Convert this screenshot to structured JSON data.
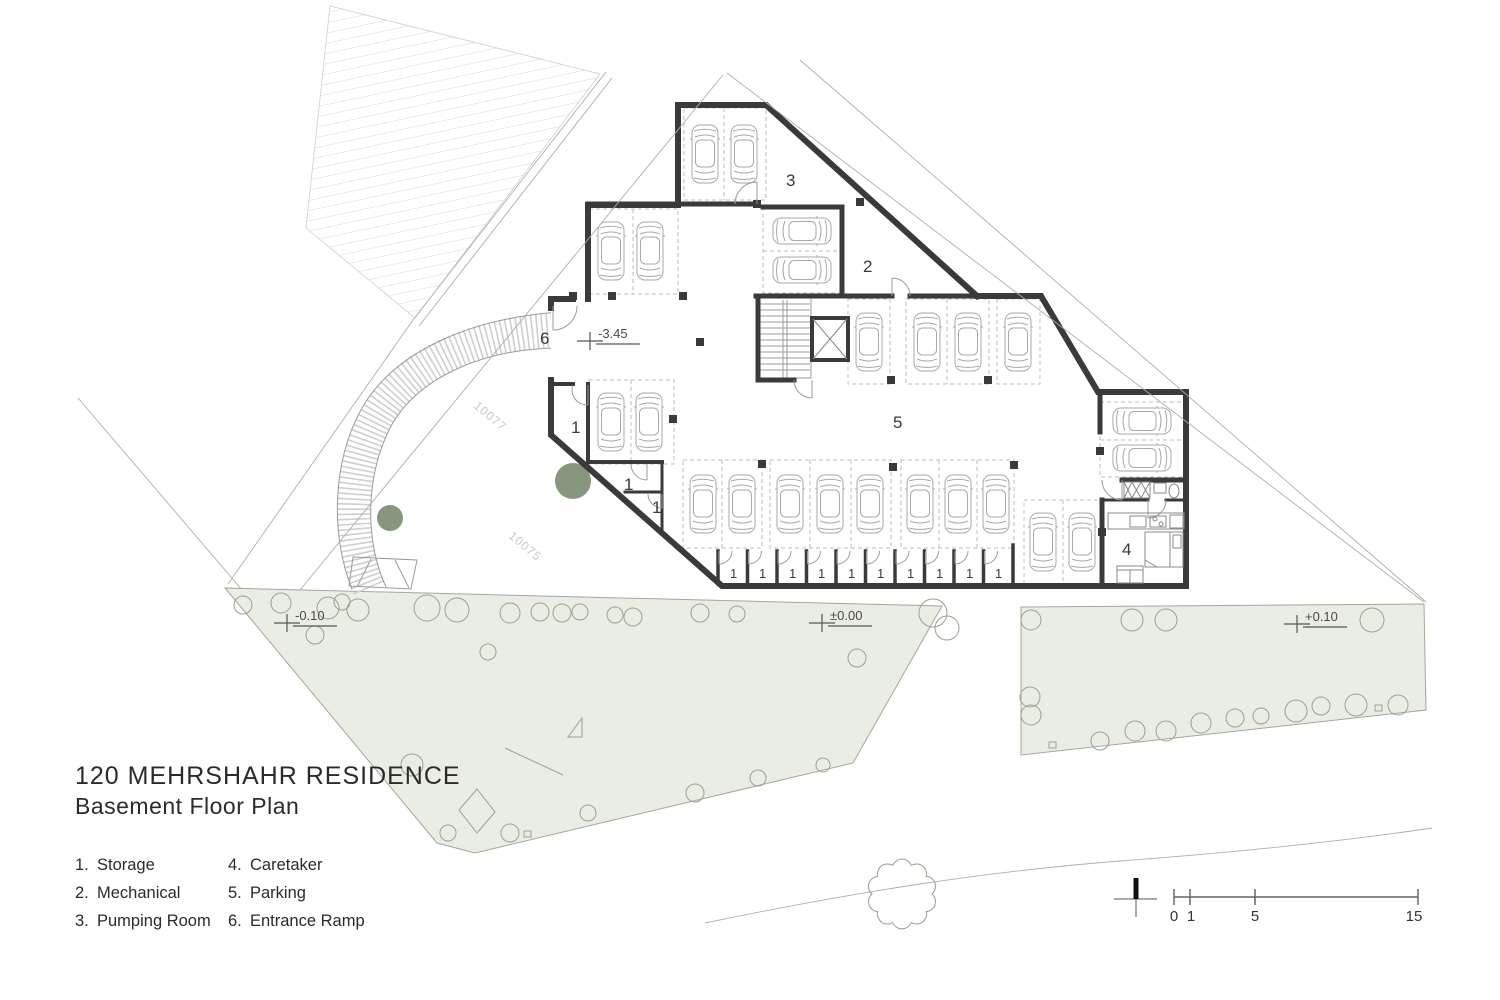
{
  "title": {
    "line1": "120 MEHRSHAHR RESIDENCE",
    "line2": "Basement Floor Plan"
  },
  "legend": {
    "items": [
      {
        "num": "1.",
        "label": "Storage"
      },
      {
        "num": "2.",
        "label": "Mechanical"
      },
      {
        "num": "3.",
        "label": "Pumping Room"
      },
      {
        "num": "4.",
        "label": "Caretaker"
      },
      {
        "num": "5.",
        "label": "Parking"
      },
      {
        "num": "6.",
        "label": "Entrance Ramp"
      }
    ]
  },
  "plan_labels": {
    "storage": "1",
    "mechanical": "2",
    "pumping": "3",
    "caretaker": "4",
    "parking": "5",
    "ramp": "6",
    "storage_cell": "1"
  },
  "levels": {
    "basement": "-3.45",
    "sidewalk_left": "-0.10",
    "sidewalk_center": "±0.00",
    "sidewalk_right": "+0.10"
  },
  "parcels": {
    "upper": "10077",
    "lower": "10075"
  },
  "scale_bar": {
    "t0": "0",
    "t1": "1",
    "t2": "5",
    "t3": "15"
  },
  "colors": {
    "wall": "#3a3a3a",
    "landscape": "#eaede4",
    "tree_fill": "#87967f",
    "text": "#2b2b2b"
  }
}
